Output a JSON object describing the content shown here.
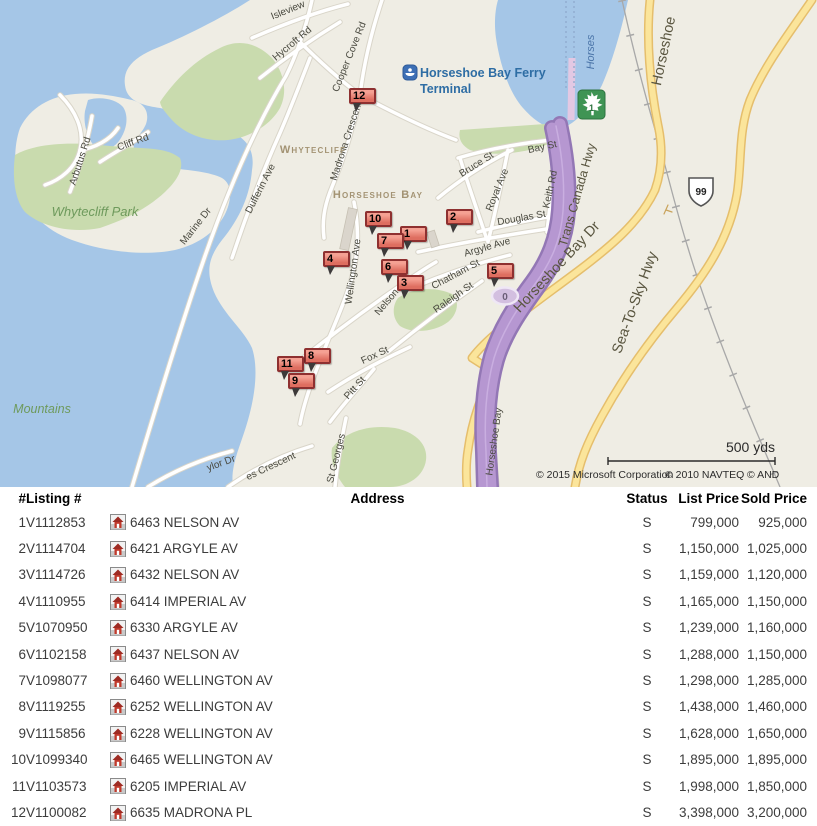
{
  "map": {
    "ferry": {
      "line1": "Horseshoe Bay Ferry",
      "line2": "Terminal"
    },
    "shields": {
      "trans_canada": "1",
      "hwy99": "99",
      "exit": "0"
    },
    "scale_label": "500 yds",
    "copyright": [
      "© 2015 Microsoft Corporation",
      "© 2010 NAVTEQ",
      "© AND"
    ],
    "labels": [
      {
        "text": "Isleview",
        "x": 289,
        "y": 13,
        "r": -22,
        "cls": "street"
      },
      {
        "text": "Hycroft Rd",
        "x": 294,
        "y": 46,
        "r": -40,
        "cls": "street"
      },
      {
        "text": "Cooper Cove Rd",
        "x": 352,
        "y": 58,
        "r": -68,
        "cls": "street"
      },
      {
        "text": "Madrona Crescent",
        "x": 349,
        "y": 142,
        "r": -72,
        "cls": "street"
      },
      {
        "text": "Dufferin Ave",
        "x": 263,
        "y": 190,
        "r": -63,
        "cls": "street"
      },
      {
        "text": "Marine Dr",
        "x": 198,
        "y": 228,
        "r": -52,
        "cls": "street"
      },
      {
        "text": "Arbutus Rd",
        "x": 83,
        "y": 162,
        "r": -72,
        "cls": "street"
      },
      {
        "text": "Cliff Rd",
        "x": 134,
        "y": 145,
        "r": -20,
        "cls": "street"
      },
      {
        "text": "Bay St",
        "x": 543,
        "y": 150,
        "r": -12,
        "cls": "street"
      },
      {
        "text": "Bruce St",
        "x": 478,
        "y": 167,
        "r": -32,
        "cls": "street"
      },
      {
        "text": "Royal Ave",
        "x": 500,
        "y": 191,
        "r": -68,
        "cls": "street"
      },
      {
        "text": "Keith Rd",
        "x": 553,
        "y": 190,
        "r": -78,
        "cls": "street"
      },
      {
        "text": "Douglas St",
        "x": 522,
        "y": 221,
        "r": -10,
        "cls": "street"
      },
      {
        "text": "Argyle Ave",
        "x": 488,
        "y": 250,
        "r": -16,
        "cls": "street"
      },
      {
        "text": "Chatham St",
        "x": 457,
        "y": 277,
        "r": -28,
        "cls": "street"
      },
      {
        "text": "Raleigh St",
        "x": 455,
        "y": 300,
        "r": -35,
        "cls": "street"
      },
      {
        "text": "Nelson",
        "x": 389,
        "y": 304,
        "r": -50,
        "cls": "street"
      },
      {
        "text": "Wellington Ave",
        "x": 356,
        "y": 272,
        "r": -82,
        "cls": "street"
      },
      {
        "text": "Fox St",
        "x": 376,
        "y": 358,
        "r": -25,
        "cls": "street"
      },
      {
        "text": "Pitt St",
        "x": 357,
        "y": 390,
        "r": -48,
        "cls": "street"
      },
      {
        "text": "St Georges",
        "x": 339,
        "y": 459,
        "r": -76,
        "cls": "street"
      },
      {
        "text": "es Crescent",
        "x": 272,
        "y": 469,
        "r": -25,
        "cls": "street"
      },
      {
        "text": "ylor Dr",
        "x": 222,
        "y": 466,
        "r": -20,
        "cls": "street"
      },
      {
        "text": "Horseshoe Bay",
        "x": 497,
        "y": 442,
        "r": -82,
        "cls": "street"
      },
      {
        "text": "Trans Canada Hwy",
        "x": 581,
        "y": 196,
        "r": -74,
        "cls": "hwy"
      },
      {
        "text": "Horseshoe Bay Dr",
        "x": 560,
        "y": 270,
        "r": -47,
        "cls": "hwy-big"
      },
      {
        "text": "Sea-To-Sky Hwy",
        "x": 639,
        "y": 304,
        "r": -70,
        "cls": "hwy-big"
      },
      {
        "text": "Horseshoe",
        "x": 668,
        "y": 52,
        "r": -78,
        "cls": "hwy-big"
      },
      {
        "text": "Whytecliff",
        "x": 313,
        "y": 153,
        "r": 0,
        "cls": "area"
      },
      {
        "text": "Horseshoe Bay",
        "x": 378,
        "y": 198,
        "r": 0,
        "cls": "area"
      },
      {
        "text": "Whytecliff Park",
        "x": 95,
        "y": 216,
        "r": 0,
        "cls": "park"
      },
      {
        "text": "Mountains",
        "x": 42,
        "y": 413,
        "r": 0,
        "cls": "park2"
      },
      {
        "text": "Horses",
        "x": 594,
        "y": 52,
        "r": -90,
        "cls": "ferry-route"
      }
    ],
    "markers": [
      {
        "n": "12",
        "x": 349,
        "y": 88
      },
      {
        "n": "2",
        "x": 446,
        "y": 209
      },
      {
        "n": "5",
        "x": 487,
        "y": 263
      },
      {
        "n": "4",
        "x": 323,
        "y": 251
      },
      {
        "n": "10",
        "x": 365,
        "y": 211
      },
      {
        "n": "1",
        "x": 400,
        "y": 226
      },
      {
        "n": "6",
        "x": 381,
        "y": 259
      },
      {
        "n": "8",
        "x": 304,
        "y": 348
      },
      {
        "n": "11",
        "x": 277,
        "y": 356
      },
      {
        "n": "7",
        "x": 377,
        "y": 233
      },
      {
        "n": "3",
        "x": 397,
        "y": 275
      },
      {
        "n": "9",
        "x": 288,
        "y": 373
      }
    ]
  },
  "table": {
    "headers": {
      "n": "#",
      "listing": "Listing #",
      "address": "Address",
      "status": "Status",
      "list": "List Price",
      "sold": "Sold Price"
    },
    "listings": [
      {
        "n": "1",
        "listing": "V1112853",
        "address": "6463 NELSON AV",
        "status": "S",
        "list": "799,000",
        "sold": "925,000"
      },
      {
        "n": "2",
        "listing": "V1114704",
        "address": "6421 ARGYLE AV",
        "status": "S",
        "list": "1,150,000",
        "sold": "1,025,000"
      },
      {
        "n": "3",
        "listing": "V1114726",
        "address": "6432 NELSON AV",
        "status": "S",
        "list": "1,159,000",
        "sold": "1,120,000"
      },
      {
        "n": "4",
        "listing": "V1110955",
        "address": "6414 IMPERIAL AV",
        "status": "S",
        "list": "1,165,000",
        "sold": "1,150,000"
      },
      {
        "n": "5",
        "listing": "V1070950",
        "address": "6330 ARGYLE AV",
        "status": "S",
        "list": "1,239,000",
        "sold": "1,160,000"
      },
      {
        "n": "6",
        "listing": "V1102158",
        "address": "6437 NELSON AV",
        "status": "S",
        "list": "1,288,000",
        "sold": "1,150,000"
      },
      {
        "n": "7",
        "listing": "V1098077",
        "address": "6460 WELLINGTON AV",
        "status": "S",
        "list": "1,298,000",
        "sold": "1,285,000"
      },
      {
        "n": "8",
        "listing": "V1119255",
        "address": "6252 WELLINGTON AV",
        "status": "S",
        "list": "1,438,000",
        "sold": "1,460,000"
      },
      {
        "n": "9",
        "listing": "V1115856",
        "address": "6228 WELLINGTON AV",
        "status": "S",
        "list": "1,628,000",
        "sold": "1,650,000"
      },
      {
        "n": "10",
        "listing": "V1099340",
        "address": "6465 WELLINGTON AV",
        "status": "S",
        "list": "1,895,000",
        "sold": "1,895,000"
      },
      {
        "n": "11",
        "listing": "V1103573",
        "address": "6205 IMPERIAL AV",
        "status": "S",
        "list": "1,998,000",
        "sold": "1,850,000"
      },
      {
        "n": "12",
        "listing": "V1100082",
        "address": "6635 MADRONA PL",
        "status": "S",
        "list": "3,398,000",
        "sold": "3,200,000"
      }
    ]
  }
}
